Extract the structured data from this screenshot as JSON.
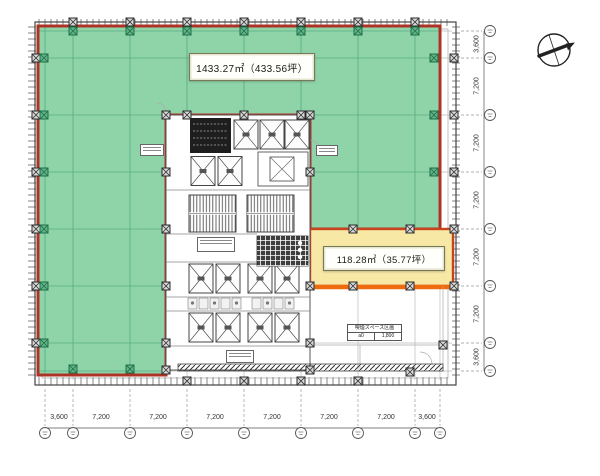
{
  "plan": {
    "area_labels": {
      "main": "1433.27㎡（433.56坪）",
      "sub": "118.28㎡（35.77坪）"
    },
    "smoking_note": {
      "title": "喫煙スペース区画",
      "cell_left": "a0",
      "cell_right": "1,800"
    },
    "dimensions": {
      "bottom": [
        "3,600",
        "7,200",
        "7,200",
        "7,200",
        "7,200",
        "7,200",
        "7,200",
        "3,600"
      ],
      "right": [
        "3,600",
        "7,200",
        "7,200",
        "7,200",
        "7,200",
        "7,200",
        "3,600"
      ]
    },
    "colors": {
      "green_fill": "#8fd4a9",
      "green_grid": "#57ac81",
      "red_border": "#ad3326",
      "yellow_fill": "#f7e8a6",
      "yellow_border": "#c8441c",
      "orange_edge": "#ee6b0e"
    }
  }
}
